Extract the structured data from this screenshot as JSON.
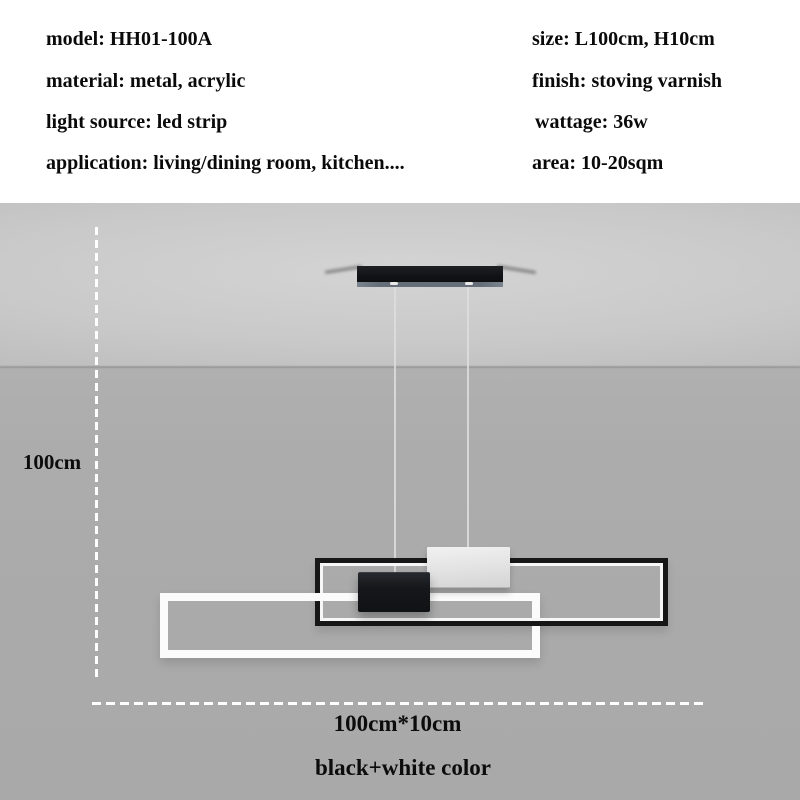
{
  "specs": {
    "left": [
      "model: HH01-100A",
      "material: metal, acrylic",
      "light source: led strip",
      "application: living/dining room, kitchen...."
    ],
    "right": [
      "size: L100cm, H10cm",
      "finish: stoving varnish",
      "wattage: 36w",
      "area: 10-20sqm"
    ]
  },
  "dimensions": {
    "drop_height": "100cm",
    "fixture_size": "100cm*10cm",
    "color_variant": "black+white color"
  },
  "colors": {
    "background_white": "#ffffff",
    "ceiling_gray": "#c9c9c9",
    "wall_gray": "#aaaaaa",
    "frame_black": "#171717",
    "frame_white": "#fbfbfb",
    "led_stripe_white": "#f7f7f7",
    "canopy_black": "#121316",
    "canopy_trim_gray": "#656e79",
    "dimension_line_white": "#ffffff",
    "text_black": "#0a0a0a"
  }
}
